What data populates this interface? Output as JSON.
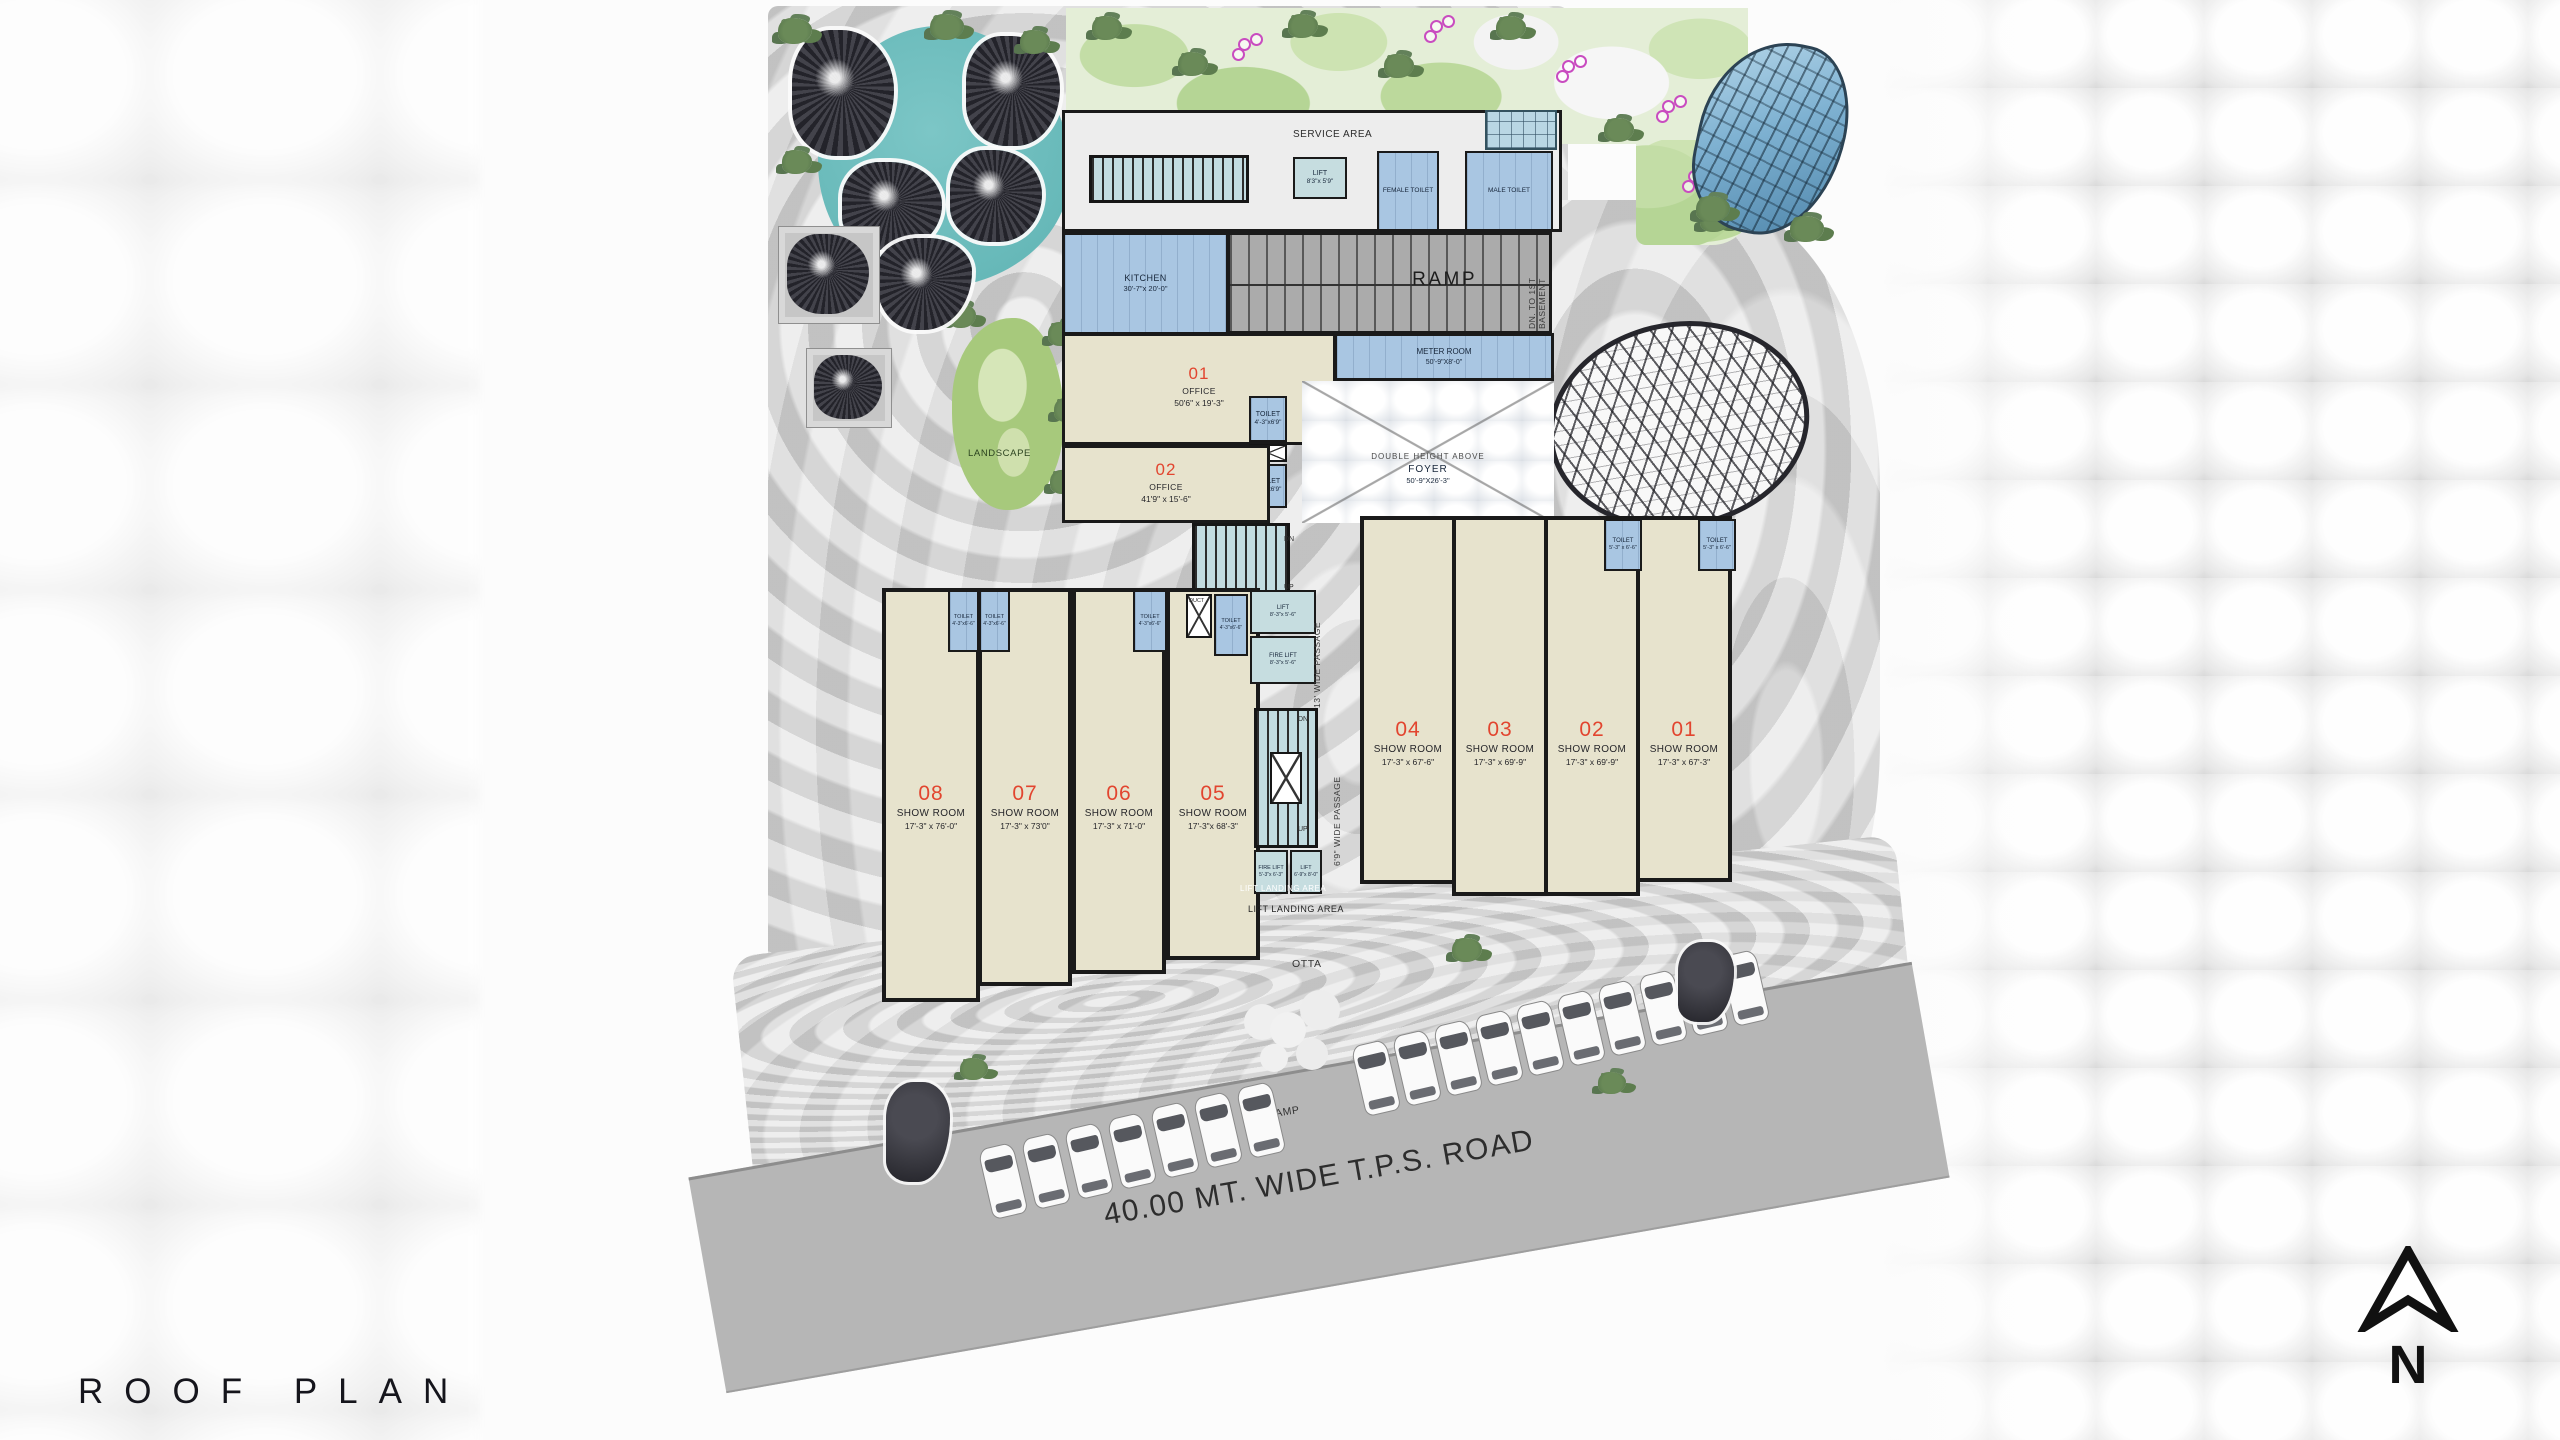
{
  "title": {
    "text": "ROOF PLAN"
  },
  "compass": {
    "label": "N"
  },
  "colors": {
    "accent_red": "#e2452f",
    "room_blue": "#a9c6e2",
    "lift_cyan": "#c6dde0",
    "floor_beige": "#e7e3cd",
    "water_teal": "#66b8b8",
    "landscape_green": "#a7c97c",
    "site_gray": "#d9d9d9",
    "road_gray": "#b6b6b6",
    "wall_black": "#1a1a1a"
  },
  "site": {
    "water_cafe": "WATER CAFE",
    "landscape": "LANDSCAPE",
    "otta": "OTTA",
    "up_ramp": "UP RAMP",
    "road": "40.00 MT. WIDE T.P.S. ROAD"
  },
  "service_block": {
    "service_area": "SERVICE AREA",
    "lift": {
      "name": "LIFT",
      "dim": "8'3\"x 5'9\""
    },
    "female_toilet": "FEMALE TOILET",
    "male_toilet": "MALE TOILET"
  },
  "ramp": {
    "label": "RAMP",
    "basement_line1": "DN. TO 1ST",
    "basement_line2": "BASEMENT"
  },
  "kitchen": {
    "name": "KITCHEN",
    "dim": "30'-7\"x 20'-0\""
  },
  "meter_room": {
    "name": "METER ROOM",
    "dim": "50'-9\"X8'-0\""
  },
  "foyer": {
    "line1": "DOUBLE HEIGHT ABOVE",
    "name": "FOYER",
    "dim": "50'-9\"X26'-3\""
  },
  "offices": [
    {
      "number": "01",
      "name": "OFFICE",
      "dim": "50'6\" x 19'-3\""
    },
    {
      "number": "02",
      "name": "OFFICE",
      "dim": "41'9\" x 15'-6\""
    }
  ],
  "office_toilets": [
    {
      "name": "TOILET",
      "dim": "4'-3\"x6'9\""
    },
    {
      "name": "TOILET",
      "dim": "4'-3\"x6'9\""
    }
  ],
  "duct": "DUCT",
  "lift_row": [
    {
      "name": "FIRE LIFT",
      "dim": "6'-9\"x 8'-3\""
    },
    {
      "name": "FIRE LIFT",
      "dim": "6'-9\"x 8'-0\""
    },
    {
      "name": "LIFT",
      "dim": "6'-9\"x 8'-0\""
    },
    {
      "name": "LIFT",
      "dim": "6'-9\"x 8'-0\""
    }
  ],
  "lobby_dim": {
    "line1": "4'-9\"",
    "line2": "x 9'-0\""
  },
  "lower_toilets": [
    {
      "name": "TOILET",
      "dim": "6'-0\"x4'-6\""
    },
    {
      "name": "TOILET",
      "dim": "6'-0\"x4'-6\""
    }
  ],
  "right_toilets": [
    {
      "name": "TOILET",
      "dim": "5'-3\" x 6'-6\""
    },
    {
      "name": "TOILET",
      "dim": "5'-3\" x 6'-6\""
    }
  ],
  "left_toilets": [
    {
      "name": "TOILET",
      "dim": "4'-3\"x6'-6\""
    },
    {
      "name": "TOILET",
      "dim": "4'-3\"x6'-6\""
    },
    {
      "name": "TOILET",
      "dim": "4'-3\"x6'-6\""
    },
    {
      "name": "TOILET",
      "dim": "4'-3\"x6'-6\""
    }
  ],
  "left_lifts": [
    {
      "name": "LIFT",
      "dim": "8'-3\"x 5'-6\""
    },
    {
      "name": "FIRE LIFT",
      "dim": "8'-3\"x 5'-6\""
    }
  ],
  "mid_lifts": [
    {
      "name": "FIRE LIFT",
      "dim": "5'-3\"x 6'-3\""
    },
    {
      "name": "LIFT",
      "dim": "6'-9\"x 8'-0\""
    }
  ],
  "stairs": {
    "dn": "DN",
    "up": "UP"
  },
  "passages": {
    "p13": "13' WIDE PASSAGE",
    "mid": "6'9\" WIDE PASSAGE"
  },
  "landing": {
    "white": "LIFT LANDING AREA",
    "black": "LIFT LANDING AREA"
  },
  "shops_left": [
    {
      "number": "08",
      "name": "SHOW ROOM",
      "dim": "17'-3\" x 76'-0\""
    },
    {
      "number": "07",
      "name": "SHOW ROOM",
      "dim": "17'-3\" x 73'0\""
    },
    {
      "number": "06",
      "name": "SHOW ROOM",
      "dim": "17'-3\" x 71'-0\""
    },
    {
      "number": "05",
      "name": "SHOW ROOM",
      "dim": "17'-3\"x 68'-3\""
    }
  ],
  "shops_right": [
    {
      "number": "04",
      "name": "SHOW ROOM",
      "dim": "17'-3\" x 67'-6\""
    },
    {
      "number": "03",
      "name": "SHOW ROOM",
      "dim": "17'-3\" x 69'-9\""
    },
    {
      "number": "02",
      "name": "SHOW ROOM",
      "dim": "17'-3\" x 69'-9\""
    },
    {
      "number": "01",
      "name": "SHOW ROOM",
      "dim": "17'-3\" x 67'-3\""
    }
  ]
}
